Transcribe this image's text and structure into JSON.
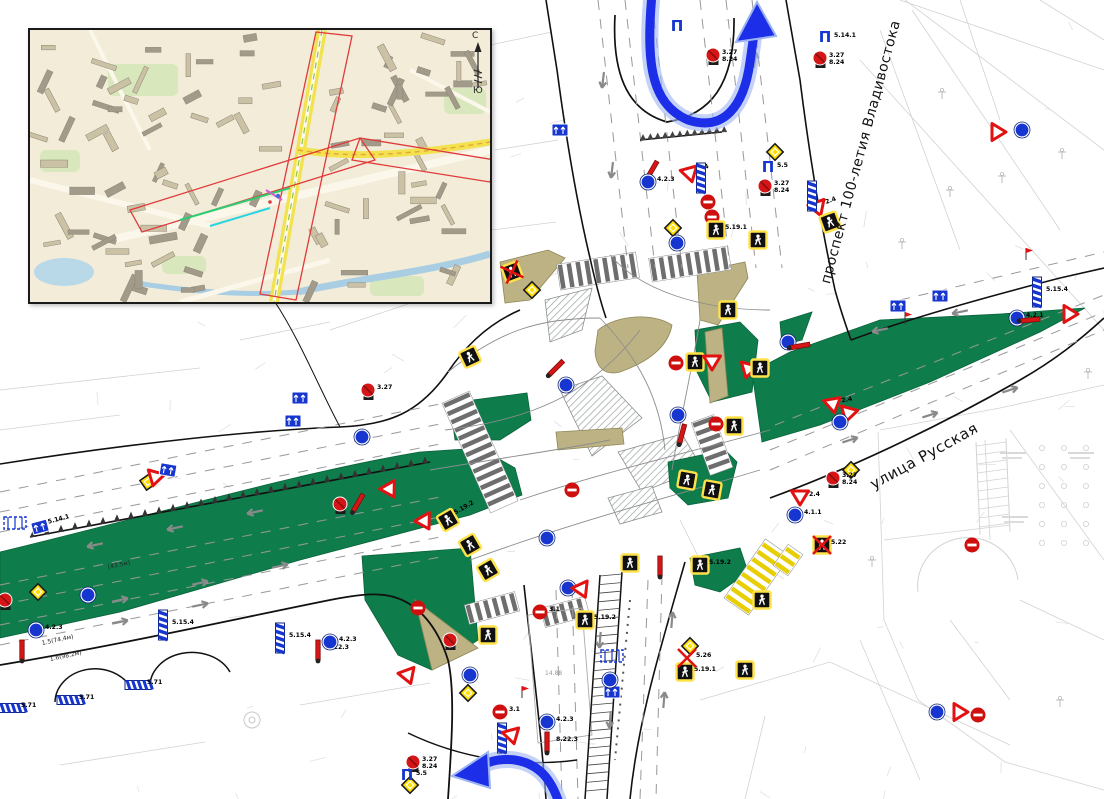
{
  "page": {
    "width": 1104,
    "height": 799,
    "background": "#ffffff"
  },
  "colors": {
    "green_median": "#0e7d4b",
    "island_tan": "#bcb283",
    "island_tan_stroke": "#8f8757",
    "arrow_blue": "#1d2ee8",
    "arrow_glow": "#9db4f2",
    "sign_red": "#d61616",
    "sign_blue": "#1636cf",
    "sign_yellow": "#ffdf00",
    "crosswalk_yellow": "#e8ce05",
    "curb_black": "#111111",
    "faint_gray": "#d2d2d2",
    "lane_gray": "#999999"
  },
  "street_labels": [
    {
      "id": "prospekt",
      "text": "проспект 100-летия Владивостока",
      "x": 861,
      "y": 152,
      "rot": -75,
      "size": 14
    },
    {
      "id": "russkaya",
      "text": "улица Русская",
      "x": 924,
      "y": 456,
      "rot": -29,
      "size": 15
    }
  ],
  "marking_labels": [
    {
      "text": "1.5(74.4м)",
      "x": 42,
      "y": 640,
      "rot": -12,
      "size": 6,
      "color": "#222222"
    },
    {
      "text": "1.6(98.2м)",
      "x": 50,
      "y": 656,
      "rot": -12,
      "size": 6,
      "color": "#222222"
    },
    {
      "text": "(43.5м)",
      "x": 108,
      "y": 564,
      "rot": -12,
      "size": 6,
      "color": "#222222"
    },
    {
      "text": "14.88",
      "x": 545,
      "y": 670,
      "rot": 0,
      "size": 6,
      "color": "#999999"
    }
  ],
  "inset": {
    "compass_north": "С",
    "compass_south": "Ю"
  },
  "icons": {
    "gantry_glyph": "П"
  },
  "signs": [
    {
      "t": "gantry",
      "x": 677,
      "y": 27
    },
    {
      "t": "nostop",
      "x": 713,
      "y": 55,
      "l": "3.27",
      "l2": "8.24"
    },
    {
      "t": "gantry",
      "x": 825,
      "y": 38,
      "l": "5.14.1"
    },
    {
      "t": "nostop",
      "x": 820,
      "y": 58,
      "l": "3.27",
      "l2": "8.24"
    },
    {
      "t": "mainroad",
      "x": 775,
      "y": 152
    },
    {
      "t": "gantry",
      "x": 768,
      "y": 168,
      "l": "5.5"
    },
    {
      "t": "nostop",
      "x": 765,
      "y": 186,
      "l": "3.27",
      "l2": "8.24"
    },
    {
      "t": "redpost",
      "x": 652,
      "y": 170,
      "r": 30
    },
    {
      "t": "bluecircle",
      "x": 648,
      "y": 182,
      "l": "4.2.3"
    },
    {
      "t": "yield",
      "x": 690,
      "y": 174,
      "r": -15,
      "l": "2.4"
    },
    {
      "t": "vstripe",
      "x": 701,
      "y": 178
    },
    {
      "t": "noentry",
      "x": 708,
      "y": 202
    },
    {
      "t": "noentry",
      "x": 712,
      "y": 217
    },
    {
      "t": "ped",
      "x": 716,
      "y": 230,
      "l": "5.19.1"
    },
    {
      "t": "mainroad",
      "x": 673,
      "y": 228
    },
    {
      "t": "bluecircle",
      "x": 677,
      "y": 243
    },
    {
      "t": "ped",
      "x": 758,
      "y": 240
    },
    {
      "t": "bluerect",
      "x": 560,
      "y": 130
    },
    {
      "t": "ped",
      "x": 512,
      "y": 272,
      "r": -20,
      "x2": true
    },
    {
      "t": "mainroad",
      "x": 532,
      "y": 290
    },
    {
      "t": "ped",
      "x": 470,
      "y": 357,
      "r": -25
    },
    {
      "t": "nostop",
      "x": 368,
      "y": 390,
      "l": "3.27"
    },
    {
      "t": "bluerect",
      "x": 300,
      "y": 398
    },
    {
      "t": "bluerect",
      "x": 293,
      "y": 421
    },
    {
      "t": "bluecircle",
      "x": 362,
      "y": 437
    },
    {
      "t": "redpost",
      "x": 556,
      "y": 368,
      "r": 45
    },
    {
      "t": "bluecircle",
      "x": 566,
      "y": 385
    },
    {
      "t": "noentry",
      "x": 676,
      "y": 363
    },
    {
      "t": "ped",
      "x": 695,
      "y": 362
    },
    {
      "t": "yield",
      "x": 712,
      "y": 362
    },
    {
      "t": "yield",
      "x": 748,
      "y": 370,
      "r": 15
    },
    {
      "t": "ped",
      "x": 760,
      "y": 368
    },
    {
      "t": "ped",
      "x": 728,
      "y": 310
    },
    {
      "t": "bluecircle",
      "x": 788,
      "y": 342
    },
    {
      "t": "redpost",
      "x": 800,
      "y": 346,
      "r": 80
    },
    {
      "t": "bluerect",
      "x": 898,
      "y": 306
    },
    {
      "t": "bluerect",
      "x": 940,
      "y": 296
    },
    {
      "t": "flag",
      "x": 905,
      "y": 318
    },
    {
      "t": "noentry",
      "x": 716,
      "y": 424
    },
    {
      "t": "ped",
      "x": 734,
      "y": 426
    },
    {
      "t": "bluecircle",
      "x": 678,
      "y": 415
    },
    {
      "t": "redpost",
      "x": 682,
      "y": 434,
      "r": 15
    },
    {
      "t": "yield",
      "x": 833,
      "y": 405,
      "r": -10,
      "l": "2.4"
    },
    {
      "t": "yield",
      "x": 848,
      "y": 414,
      "r": 15
    },
    {
      "t": "bluecircle",
      "x": 840,
      "y": 422
    },
    {
      "t": "mainroad",
      "x": 851,
      "y": 470,
      "r": 0
    },
    {
      "t": "nostop",
      "x": 833,
      "y": 478,
      "l": "3.27",
      "l2": "8.24"
    },
    {
      "t": "yield",
      "x": 800,
      "y": 497,
      "l": "2.4"
    },
    {
      "t": "bluecircle",
      "x": 795,
      "y": 515,
      "l": "4.1.1"
    },
    {
      "t": "ped",
      "x": 822,
      "y": 545,
      "l": "5.22",
      "x2": true
    },
    {
      "t": "yield",
      "x": 818,
      "y": 208,
      "r": -20,
      "l": "2.4"
    },
    {
      "t": "ped",
      "x": 830,
      "y": 222,
      "r": -20
    },
    {
      "t": "vstripe",
      "x": 812,
      "y": 196
    },
    {
      "t": "yield",
      "x": 998,
      "y": 132,
      "r": -90
    },
    {
      "t": "bluecircle",
      "x": 1022,
      "y": 130
    },
    {
      "t": "bluecircle",
      "x": 1017,
      "y": 318,
      "l": "4.2.1"
    },
    {
      "t": "redpost",
      "x": 1030,
      "y": 320,
      "r": 85
    },
    {
      "t": "vstripe",
      "x": 1037,
      "y": 292,
      "l": "5.15.4"
    },
    {
      "t": "flag",
      "x": 1026,
      "y": 254
    },
    {
      "t": "yield",
      "x": 1070,
      "y": 314,
      "r": -90
    },
    {
      "t": "noentry",
      "x": 972,
      "y": 545
    },
    {
      "t": "bluecircle",
      "x": 937,
      "y": 712
    },
    {
      "t": "yield",
      "x": 960,
      "y": 712,
      "r": -90
    },
    {
      "t": "noentry",
      "x": 978,
      "y": 715
    },
    {
      "t": "mainroad",
      "x": 148,
      "y": 482,
      "r": 10
    },
    {
      "t": "yield",
      "x": 155,
      "y": 478,
      "r": 15
    },
    {
      "t": "bluerect",
      "x": 168,
      "y": 470,
      "r": 10
    },
    {
      "t": "bluerect",
      "x": 40,
      "y": 527,
      "r": -15,
      "l": "5.14.1"
    },
    {
      "t": "shelter",
      "x": 15,
      "y": 523
    },
    {
      "t": "mainroad",
      "x": 38,
      "y": 592
    },
    {
      "t": "bluecircle",
      "x": 88,
      "y": 595
    },
    {
      "t": "nostop",
      "x": 5,
      "y": 600
    },
    {
      "t": "bluecircle",
      "x": 36,
      "y": 630,
      "l": "4.2.3"
    },
    {
      "t": "redpost",
      "x": 22,
      "y": 650
    },
    {
      "t": "hstripe",
      "x": 70,
      "y": 700,
      "l": "5.71"
    },
    {
      "t": "hstripe",
      "x": 138,
      "y": 685,
      "l": "5.71"
    },
    {
      "t": "hstripe",
      "x": 12,
      "y": 708,
      "l": "5.71"
    },
    {
      "t": "vstripe",
      "x": 163,
      "y": 625,
      "l": "5.15.4"
    },
    {
      "t": "vstripe",
      "x": 280,
      "y": 638,
      "l": "5.15.4"
    },
    {
      "t": "redpost",
      "x": 318,
      "y": 650,
      "l": "8.22.3"
    },
    {
      "t": "bluecircle",
      "x": 330,
      "y": 642,
      "l": "4.2.3"
    },
    {
      "t": "nostop",
      "x": 340,
      "y": 504
    },
    {
      "t": "redpost",
      "x": 358,
      "y": 503,
      "r": 30
    },
    {
      "t": "yield",
      "x": 390,
      "y": 490,
      "r": -30
    },
    {
      "t": "yield",
      "x": 425,
      "y": 522,
      "r": -30
    },
    {
      "t": "ped",
      "x": 448,
      "y": 520,
      "r": -30,
      "l": "5.19.2"
    },
    {
      "t": "ped",
      "x": 470,
      "y": 545,
      "r": -30
    },
    {
      "t": "ped",
      "x": 488,
      "y": 570,
      "r": -30
    },
    {
      "t": "noentry",
      "x": 572,
      "y": 490
    },
    {
      "t": "bluecircle",
      "x": 547,
      "y": 538
    },
    {
      "t": "noentry",
      "x": 418,
      "y": 608
    },
    {
      "t": "nostop",
      "x": 450,
      "y": 640
    },
    {
      "t": "ped",
      "x": 488,
      "y": 635
    },
    {
      "t": "ped",
      "x": 585,
      "y": 620,
      "l": "5.19.2"
    },
    {
      "t": "noentry",
      "x": 540,
      "y": 612,
      "l": "3.1"
    },
    {
      "t": "bluecircle",
      "x": 568,
      "y": 588
    },
    {
      "t": "yield",
      "x": 582,
      "y": 590,
      "r": -25
    },
    {
      "t": "ped",
      "x": 630,
      "y": 563
    },
    {
      "t": "yield",
      "x": 408,
      "y": 676,
      "r": -20
    },
    {
      "t": "bluecircle",
      "x": 470,
      "y": 675
    },
    {
      "t": "mainroad",
      "x": 468,
      "y": 693
    },
    {
      "t": "mainroad",
      "x": 410,
      "y": 785
    },
    {
      "t": "nostop",
      "x": 413,
      "y": 762,
      "l": "3.27",
      "l2": "8.24"
    },
    {
      "t": "gantry",
      "x": 407,
      "y": 776,
      "l": "5.5"
    },
    {
      "t": "noentry",
      "x": 500,
      "y": 712,
      "l": "3.1"
    },
    {
      "t": "vstripe",
      "x": 502,
      "y": 738
    },
    {
      "t": "yield",
      "x": 512,
      "y": 736,
      "r": -15
    },
    {
      "t": "bluecircle",
      "x": 547,
      "y": 722,
      "l": "4.2.3"
    },
    {
      "t": "redpost",
      "x": 547,
      "y": 742,
      "l": "8.22.3"
    },
    {
      "t": "flag",
      "x": 522,
      "y": 692
    },
    {
      "t": "redpost",
      "x": 660,
      "y": 566
    },
    {
      "t": "ped",
      "x": 700,
      "y": 565,
      "l": "5.19.2"
    },
    {
      "t": "ped",
      "x": 687,
      "y": 480,
      "r": 10
    },
    {
      "t": "ped",
      "x": 712,
      "y": 490,
      "r": 10
    },
    {
      "t": "ped",
      "x": 685,
      "y": 672,
      "l": "5.19.1"
    },
    {
      "t": "ped",
      "x": 745,
      "y": 670
    },
    {
      "t": "ped",
      "x": 762,
      "y": 600
    },
    {
      "t": "mainroad",
      "x": 690,
      "y": 646
    },
    {
      "t": "redx",
      "x": 687,
      "y": 658,
      "l": "5.26"
    },
    {
      "t": "shelter",
      "x": 612,
      "y": 656
    },
    {
      "t": "bluerect",
      "x": 612,
      "y": 692
    },
    {
      "t": "bluecircle",
      "x": 610,
      "y": 680
    }
  ]
}
